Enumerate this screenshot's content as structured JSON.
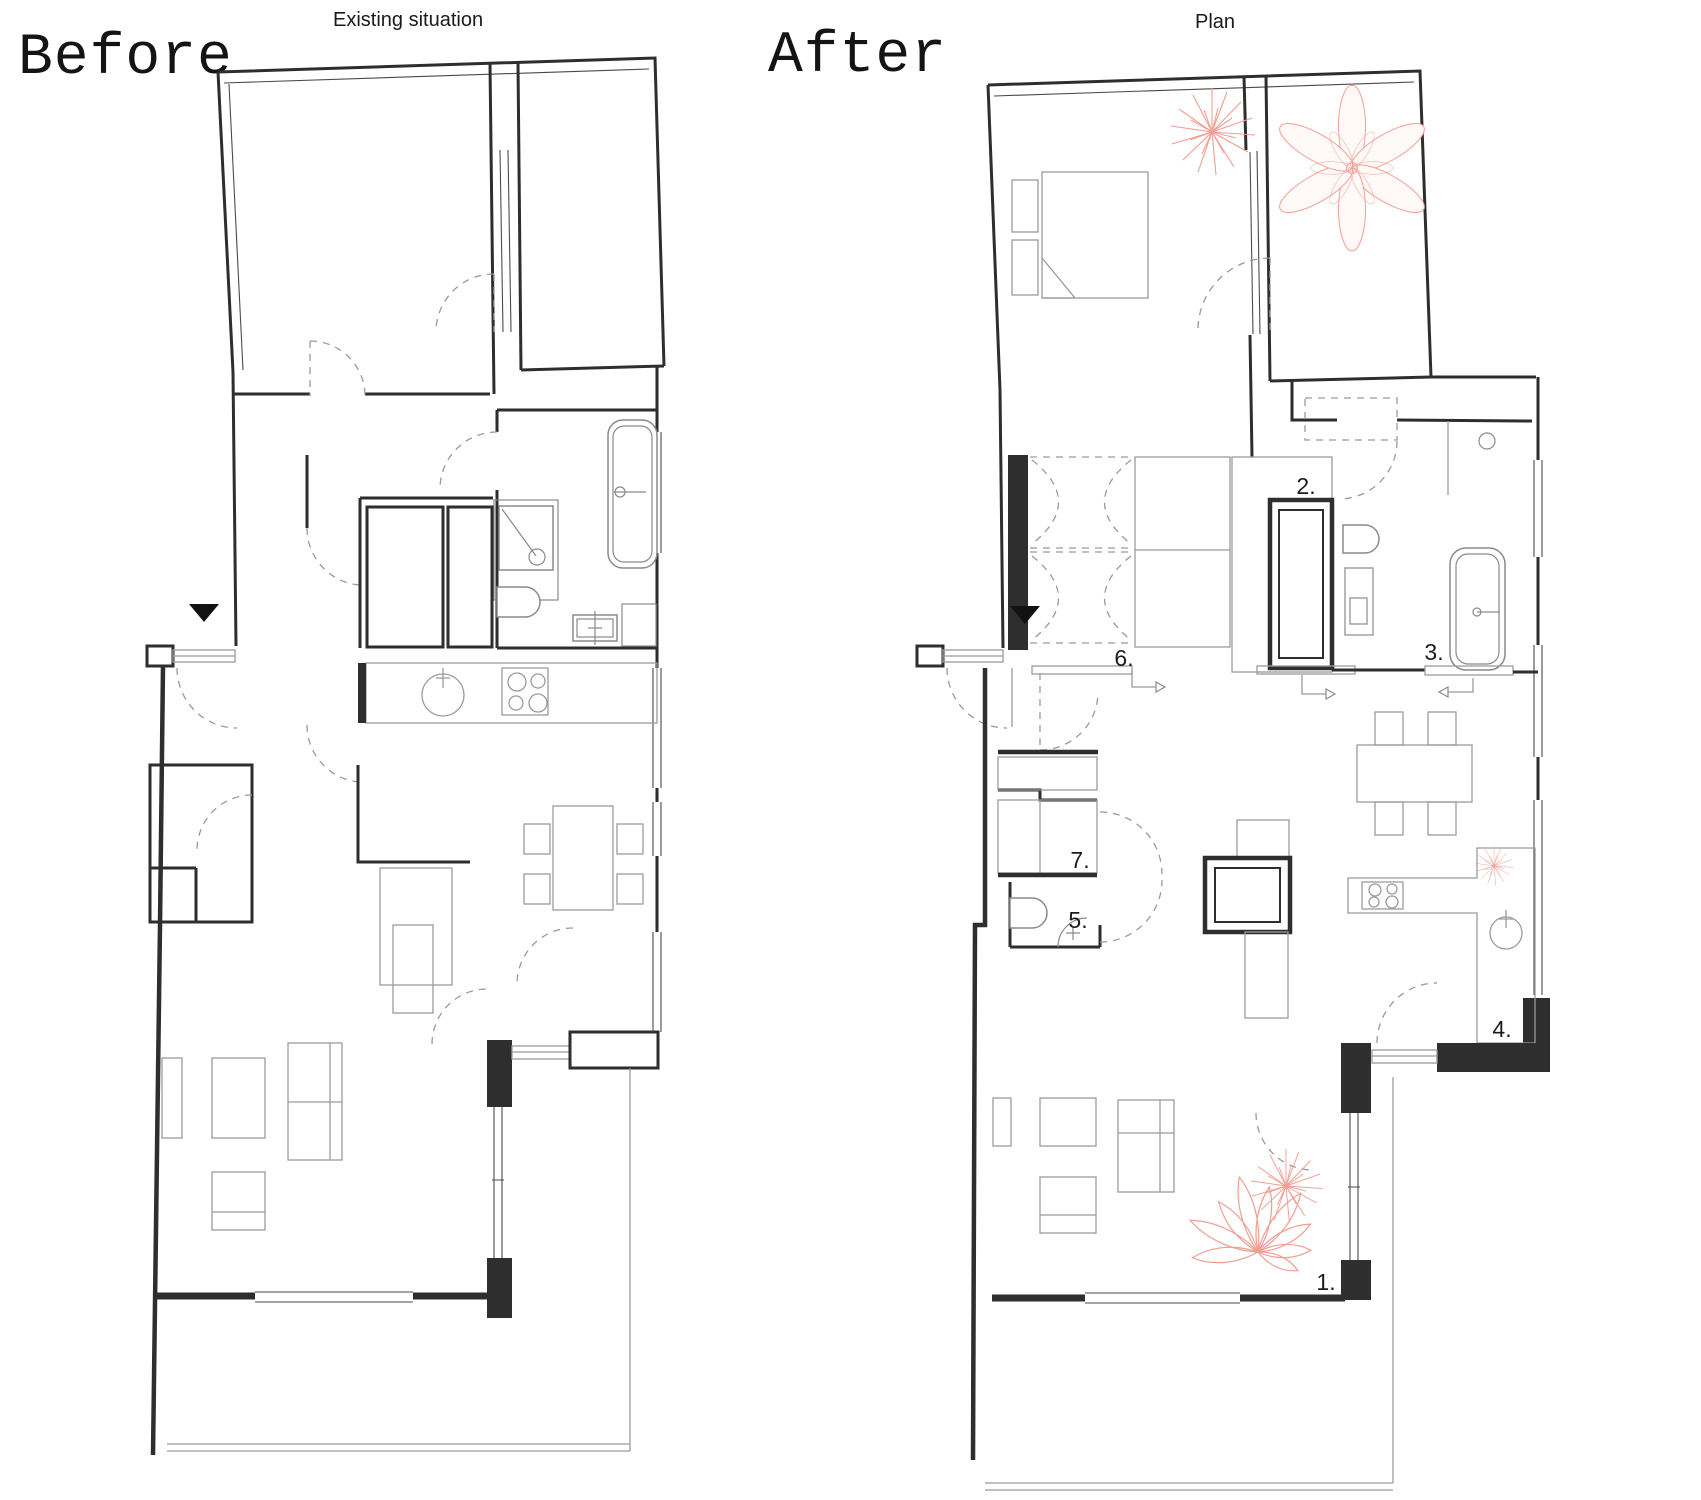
{
  "panels": {
    "before": {
      "heading": "Before",
      "title": "Existing situation"
    },
    "after": {
      "heading": "After",
      "title": "Plan"
    }
  },
  "annotations": [
    "1.",
    "2.",
    "3.",
    "4.",
    "5.",
    "6.",
    "7."
  ],
  "colors": {
    "wall": "#2e2e2e",
    "furniture": "#9b9b9b",
    "fixture": "#8a8a8a",
    "door": "#9a9a9a",
    "plant": "#f19e92",
    "label": "#1c1c1c",
    "background": "#ffffff"
  }
}
